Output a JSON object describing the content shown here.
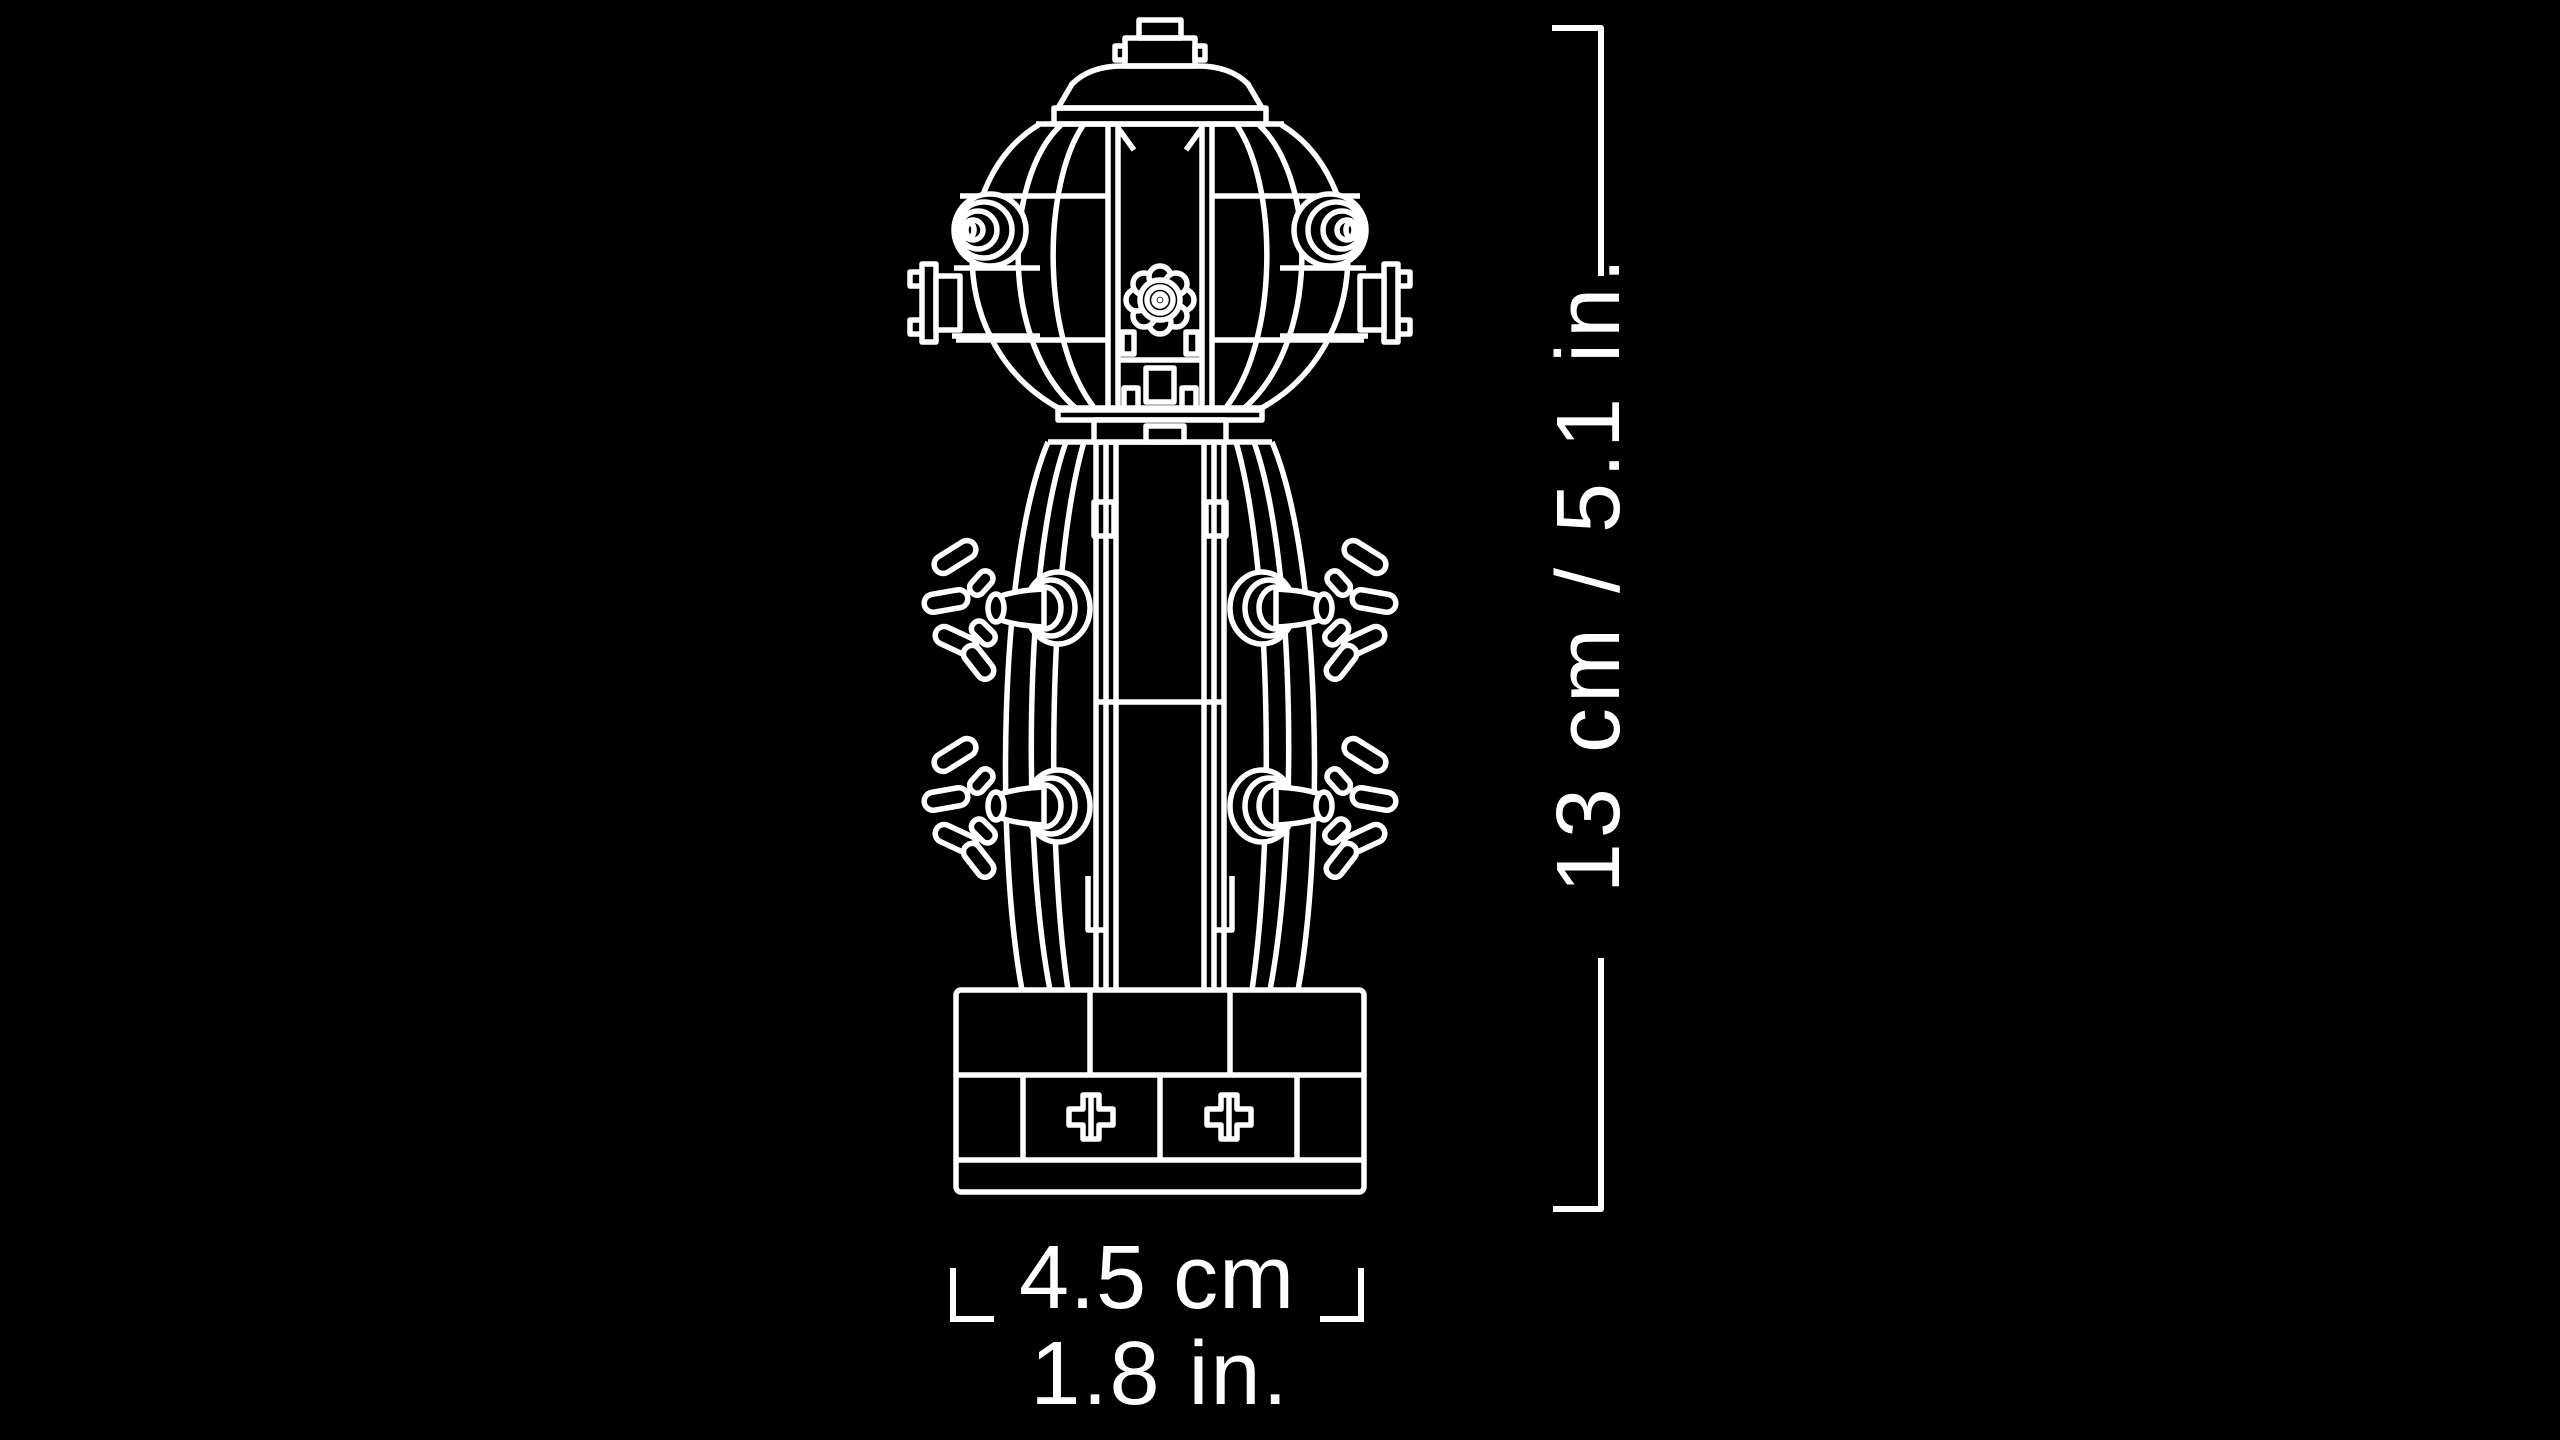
{
  "scene": {
    "background_color": "#000000",
    "line_color": "#ffffff"
  },
  "dimensions": {
    "height_label": "13 cm / 5.1 in.",
    "width_label_cm": "4.5 cm",
    "width_label_in": "1.8 in."
  },
  "illustration": {
    "name": "brick-built-model-line-art",
    "parts": [
      "top-cap",
      "dome",
      "upper-barrel",
      "side-ports",
      "flower-valve",
      "side-flanges",
      "lower-barrel",
      "splash-nozzles",
      "brick-base",
      "cross-emblems"
    ]
  }
}
